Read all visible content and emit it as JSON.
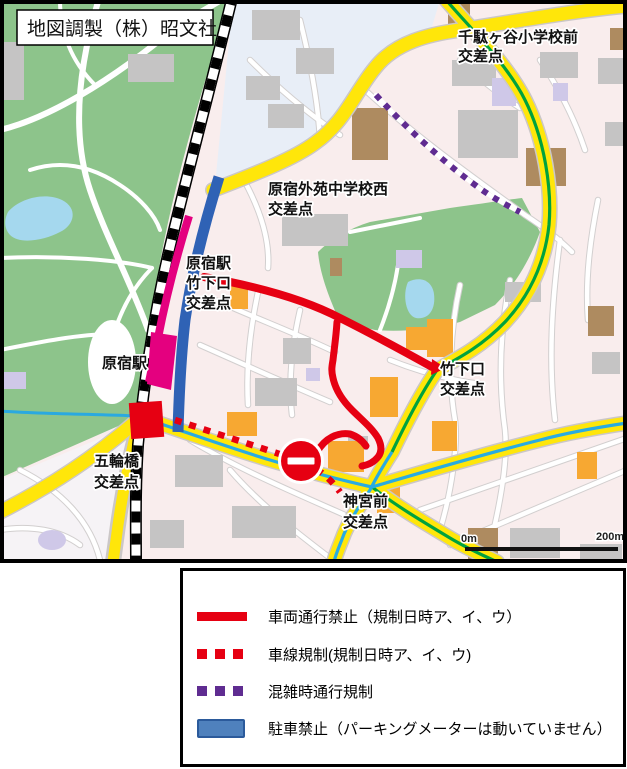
{
  "map": {
    "credit": "地図調製（株）昭文社",
    "labels": {
      "sendagayaElementary": [
        "千駄ヶ谷小学校前",
        "交差点"
      ],
      "gaienJuniorHighWest": [
        "原宿外苑中学校西",
        "交差点"
      ],
      "harajukuTakeshitaExit": [
        "原宿駅",
        "竹下口",
        "交差点"
      ],
      "harajukuStation": "原宿駅",
      "takeshitaGuchi": [
        "竹下口",
        "交差点"
      ],
      "gorinbashi": [
        "五輪橋",
        "交差点"
      ],
      "jingumae": [
        "神宮前",
        "交差点"
      ]
    },
    "scale": {
      "start": "0m",
      "end": "200m"
    }
  },
  "legend": {
    "items": [
      {
        "id": "vehicle-ban",
        "swatch": "solid-red-line",
        "label": "車両通行禁止（規制日時ア、イ、ウ）"
      },
      {
        "id": "lane-restriction",
        "swatch": "red-dotted-line",
        "label": "車線規制(規制日時ア、イ、ウ)"
      },
      {
        "id": "congestion-restriction",
        "swatch": "purple-dotted-line",
        "label": "混雑時通行規制"
      },
      {
        "id": "no-parking",
        "swatch": "blue-band",
        "label": "駐車禁止（パーキングメーターは動いていません）"
      }
    ]
  },
  "colors": {
    "road_yellow": "#ffe60a",
    "route_green": "#00a23e",
    "route_cyan": "#29abe2",
    "restriction_red": "#e60012",
    "congestion_purple": "#5f2c91",
    "no_parking_blue_fill": "#4f81bd",
    "no_parking_blue_border": "#2b5a9b",
    "station_magenta": "#e4007f",
    "park_green": "#8dc48b",
    "water_blue": "#a5d8ee",
    "residential_pink": "#f9eded",
    "district_blue": "#e8eef7"
  }
}
